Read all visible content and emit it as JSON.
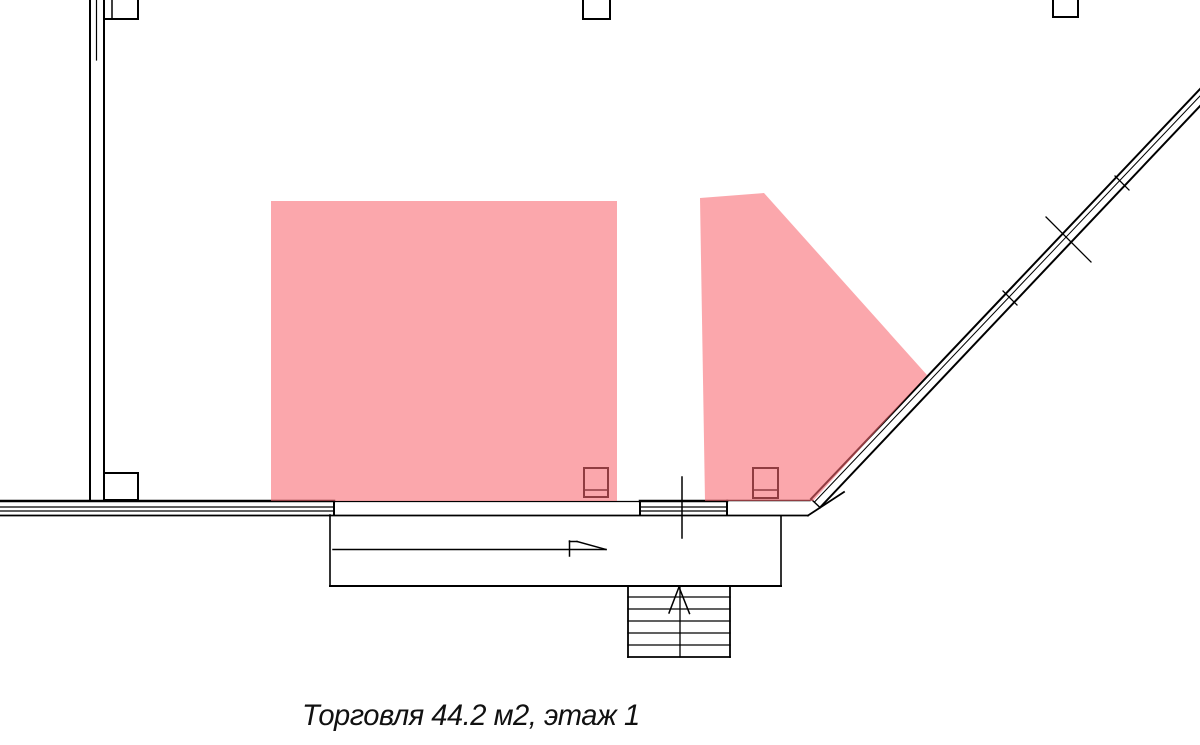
{
  "plan": {
    "caption": "Торговля 44.2 м2, этаж 1",
    "area_type": "Торговля",
    "area_m2": "44.2",
    "floor": "1"
  },
  "colors": {
    "highlight": "rgba(248,103,112,0.58)",
    "line": "#000000",
    "background": "#ffffff"
  }
}
